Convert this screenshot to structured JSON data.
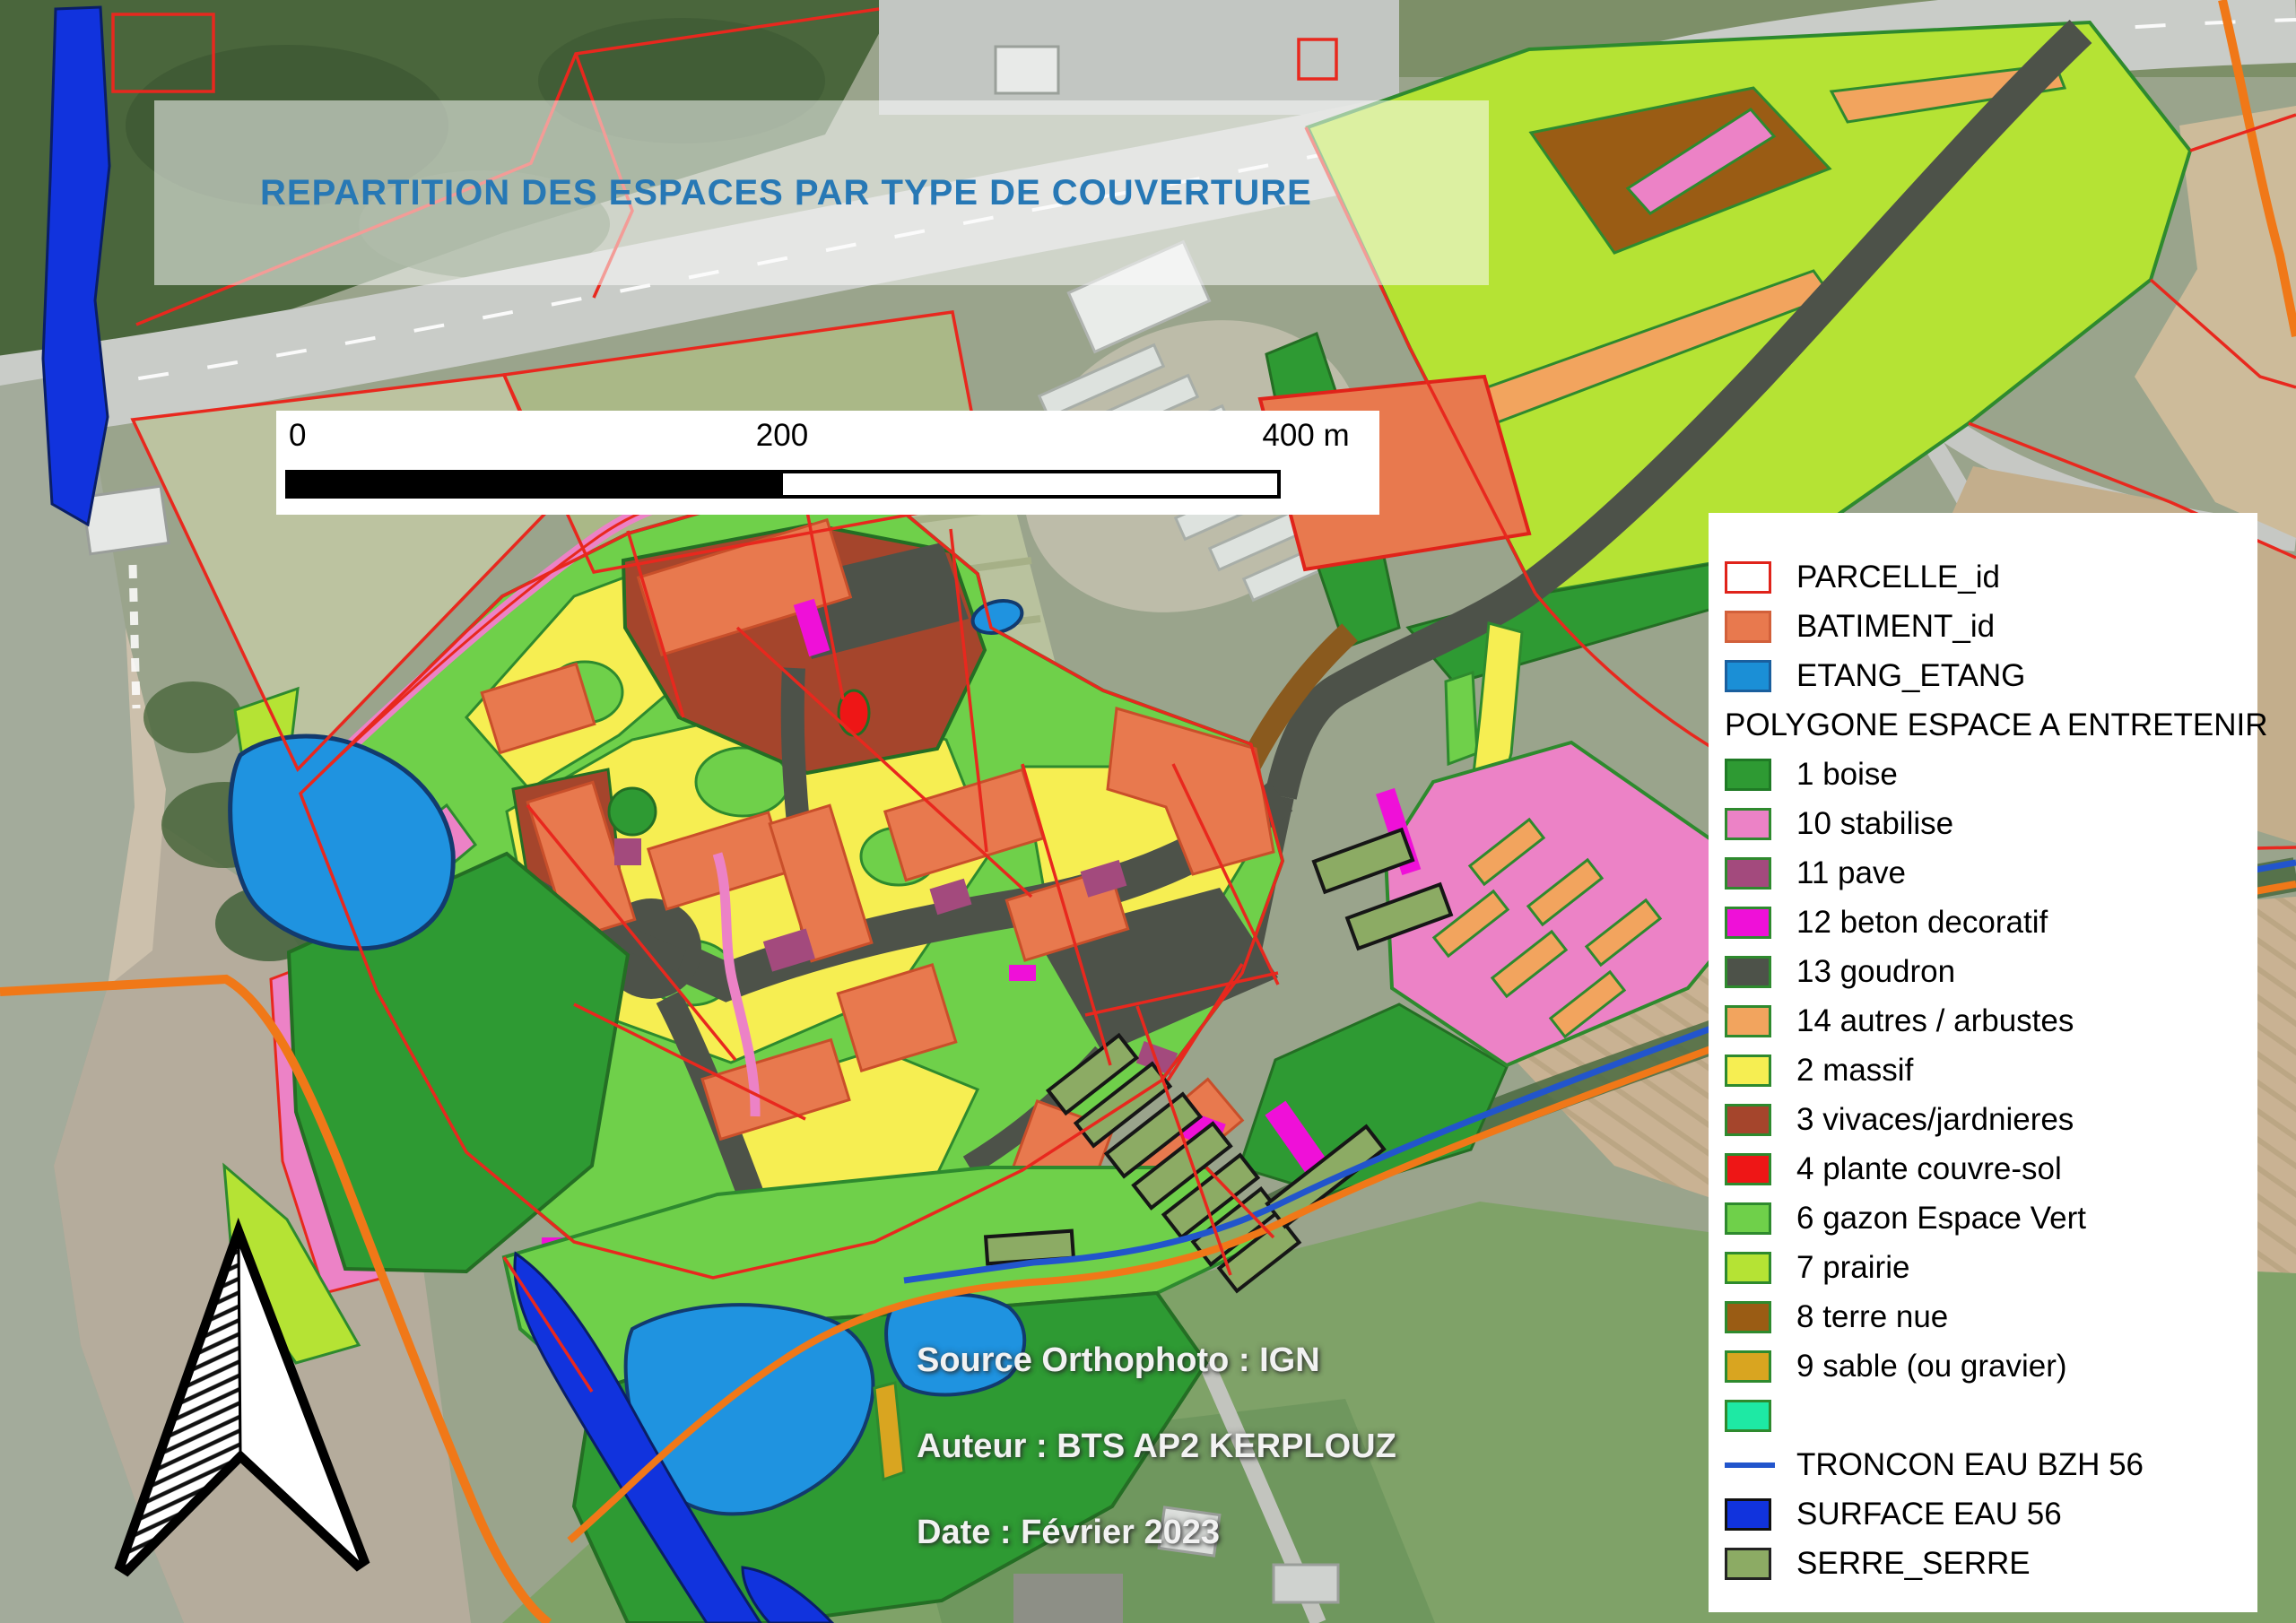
{
  "title": {
    "text": "REPARTITION DES ESPACES PAR TYPE DE COUVERTURE",
    "color": "#2778b5"
  },
  "scalebar": {
    "start": "0",
    "middle": "200",
    "end": "400 m"
  },
  "legend": {
    "sections": [
      {
        "items": [
          {
            "label": "PARCELLE_id",
            "fill": "#ffffff",
            "border": "#e0231a"
          },
          {
            "label": "BATIMENT_id",
            "fill": "#e8794e",
            "border": "#d2603a"
          },
          {
            "label": "ETANG_ETANG",
            "fill": "#1b8fd6",
            "border": "#1a5f9e"
          }
        ]
      },
      {
        "header": "POLYGONE ESPACE A ENTRETENIR",
        "items": [
          {
            "label": "1 boise",
            "fill": "#2e9a33",
            "border": "#1f7a25"
          },
          {
            "label": "10 stabilise",
            "fill": "#ec82c6",
            "border": "#2e8a2e"
          },
          {
            "label": "11 pave",
            "fill": "#a34a7d",
            "border": "#2e8a2e"
          },
          {
            "label": "12 beton decoratif",
            "fill": "#ef10d8",
            "border": "#2e8a2e"
          },
          {
            "label": "13 goudron",
            "fill": "#4d5249",
            "border": "#2e8a2e"
          },
          {
            "label": "14 autres / arbustes",
            "fill": "#f2a45e",
            "border": "#2e8a2e"
          },
          {
            "label": "2 massif",
            "fill": "#f6ee52",
            "border": "#2e8a2e"
          },
          {
            "label": "3 vivaces/jardnieres",
            "fill": "#a5452c",
            "border": "#2e8a2e"
          },
          {
            "label": "4 plante couvre-sol",
            "fill": "#ee1616",
            "border": "#2e8a2e"
          },
          {
            "label": "6 gazon Espace Vert",
            "fill": "#6fd04a",
            "border": "#2e8a2e"
          },
          {
            "label": "7 prairie",
            "fill": "#b5e334",
            "border": "#2e8a2e"
          },
          {
            "label": "8 terre nue",
            "fill": "#9a5c14",
            "border": "#2e8a2e"
          },
          {
            "label": "9 sable (ou gravier)",
            "fill": "#d9a520",
            "border": "#2e8a2e"
          },
          {
            "label": "",
            "fill": "#1ee9a4",
            "border": "#2e8a2e"
          }
        ]
      },
      {
        "items": [
          {
            "label": "TRONCON EAU BZH 56",
            "kind": "line",
            "color": "#2255cc"
          },
          {
            "label": "SURFACE EAU 56",
            "fill": "#1133dd",
            "border": "#111111"
          },
          {
            "label": "SERRE_SERRE",
            "fill": "#8cab64",
            "border": "#222222"
          }
        ]
      }
    ]
  },
  "source": {
    "lines": [
      "Source Orthophoto : IGN",
      "Auteur : BTS AP2 KERPLOUZ",
      "Date : Février 2023"
    ]
  }
}
